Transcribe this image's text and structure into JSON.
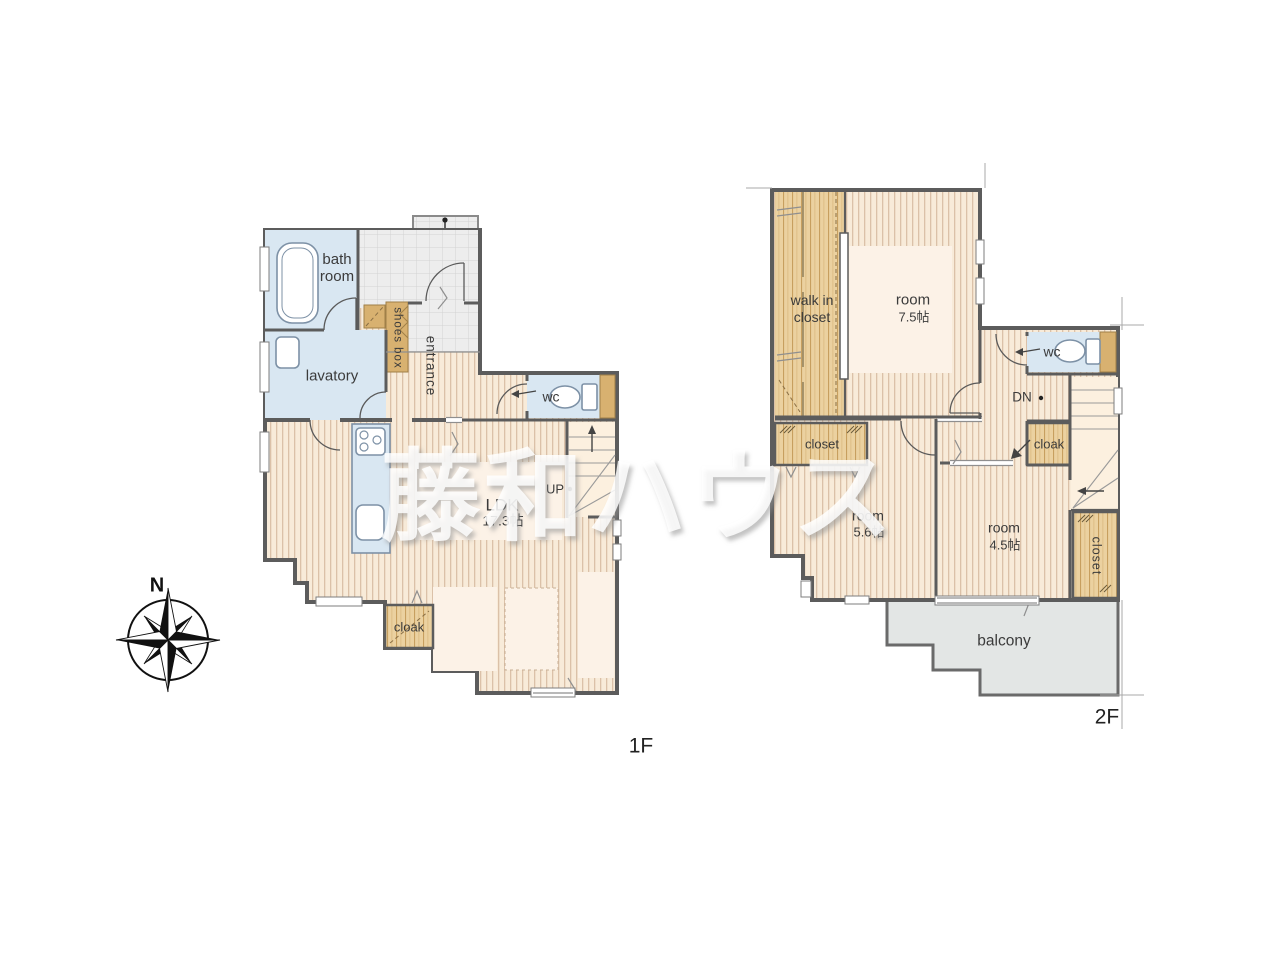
{
  "watermark": {
    "text": "藤和ハウス"
  },
  "compass": {
    "north_label": "N"
  },
  "floor_1": {
    "floor_label": "1F",
    "bathroom": "bath room",
    "lavatory": "lavatory",
    "shoes_box": "shoes box",
    "entrance": "entrance",
    "wc": "wc",
    "stairs_direction": "UP",
    "ldk_name": "LDK",
    "ldk_size": "17.3帖",
    "cloak": "cloak"
  },
  "floor_2": {
    "floor_label": "2F",
    "walk_in_closet": "walk in closet",
    "room_a_name": "room",
    "room_a_size": "7.5帖",
    "wc": "wc",
    "stairs_direction": "DN",
    "cloak": "cloak",
    "closet_a": "closet",
    "room_b_name": "room",
    "room_b_size": "5.6帖",
    "room_c_name": "room",
    "room_c_size": "4.5帖",
    "closet_b": "closet",
    "balcony": "balcony"
  },
  "colors": {
    "wood_floor": "#f8ebd9",
    "wood_stripe": "#dbc1a8",
    "closet_wood": "#ebd1a0",
    "accent_tan": "#d8b170",
    "water_blue": "#d9e7f2",
    "tile_gray": "#ededed",
    "balcony_gray": "#e3e6e5",
    "wall_gray": "#5c5c5c"
  }
}
